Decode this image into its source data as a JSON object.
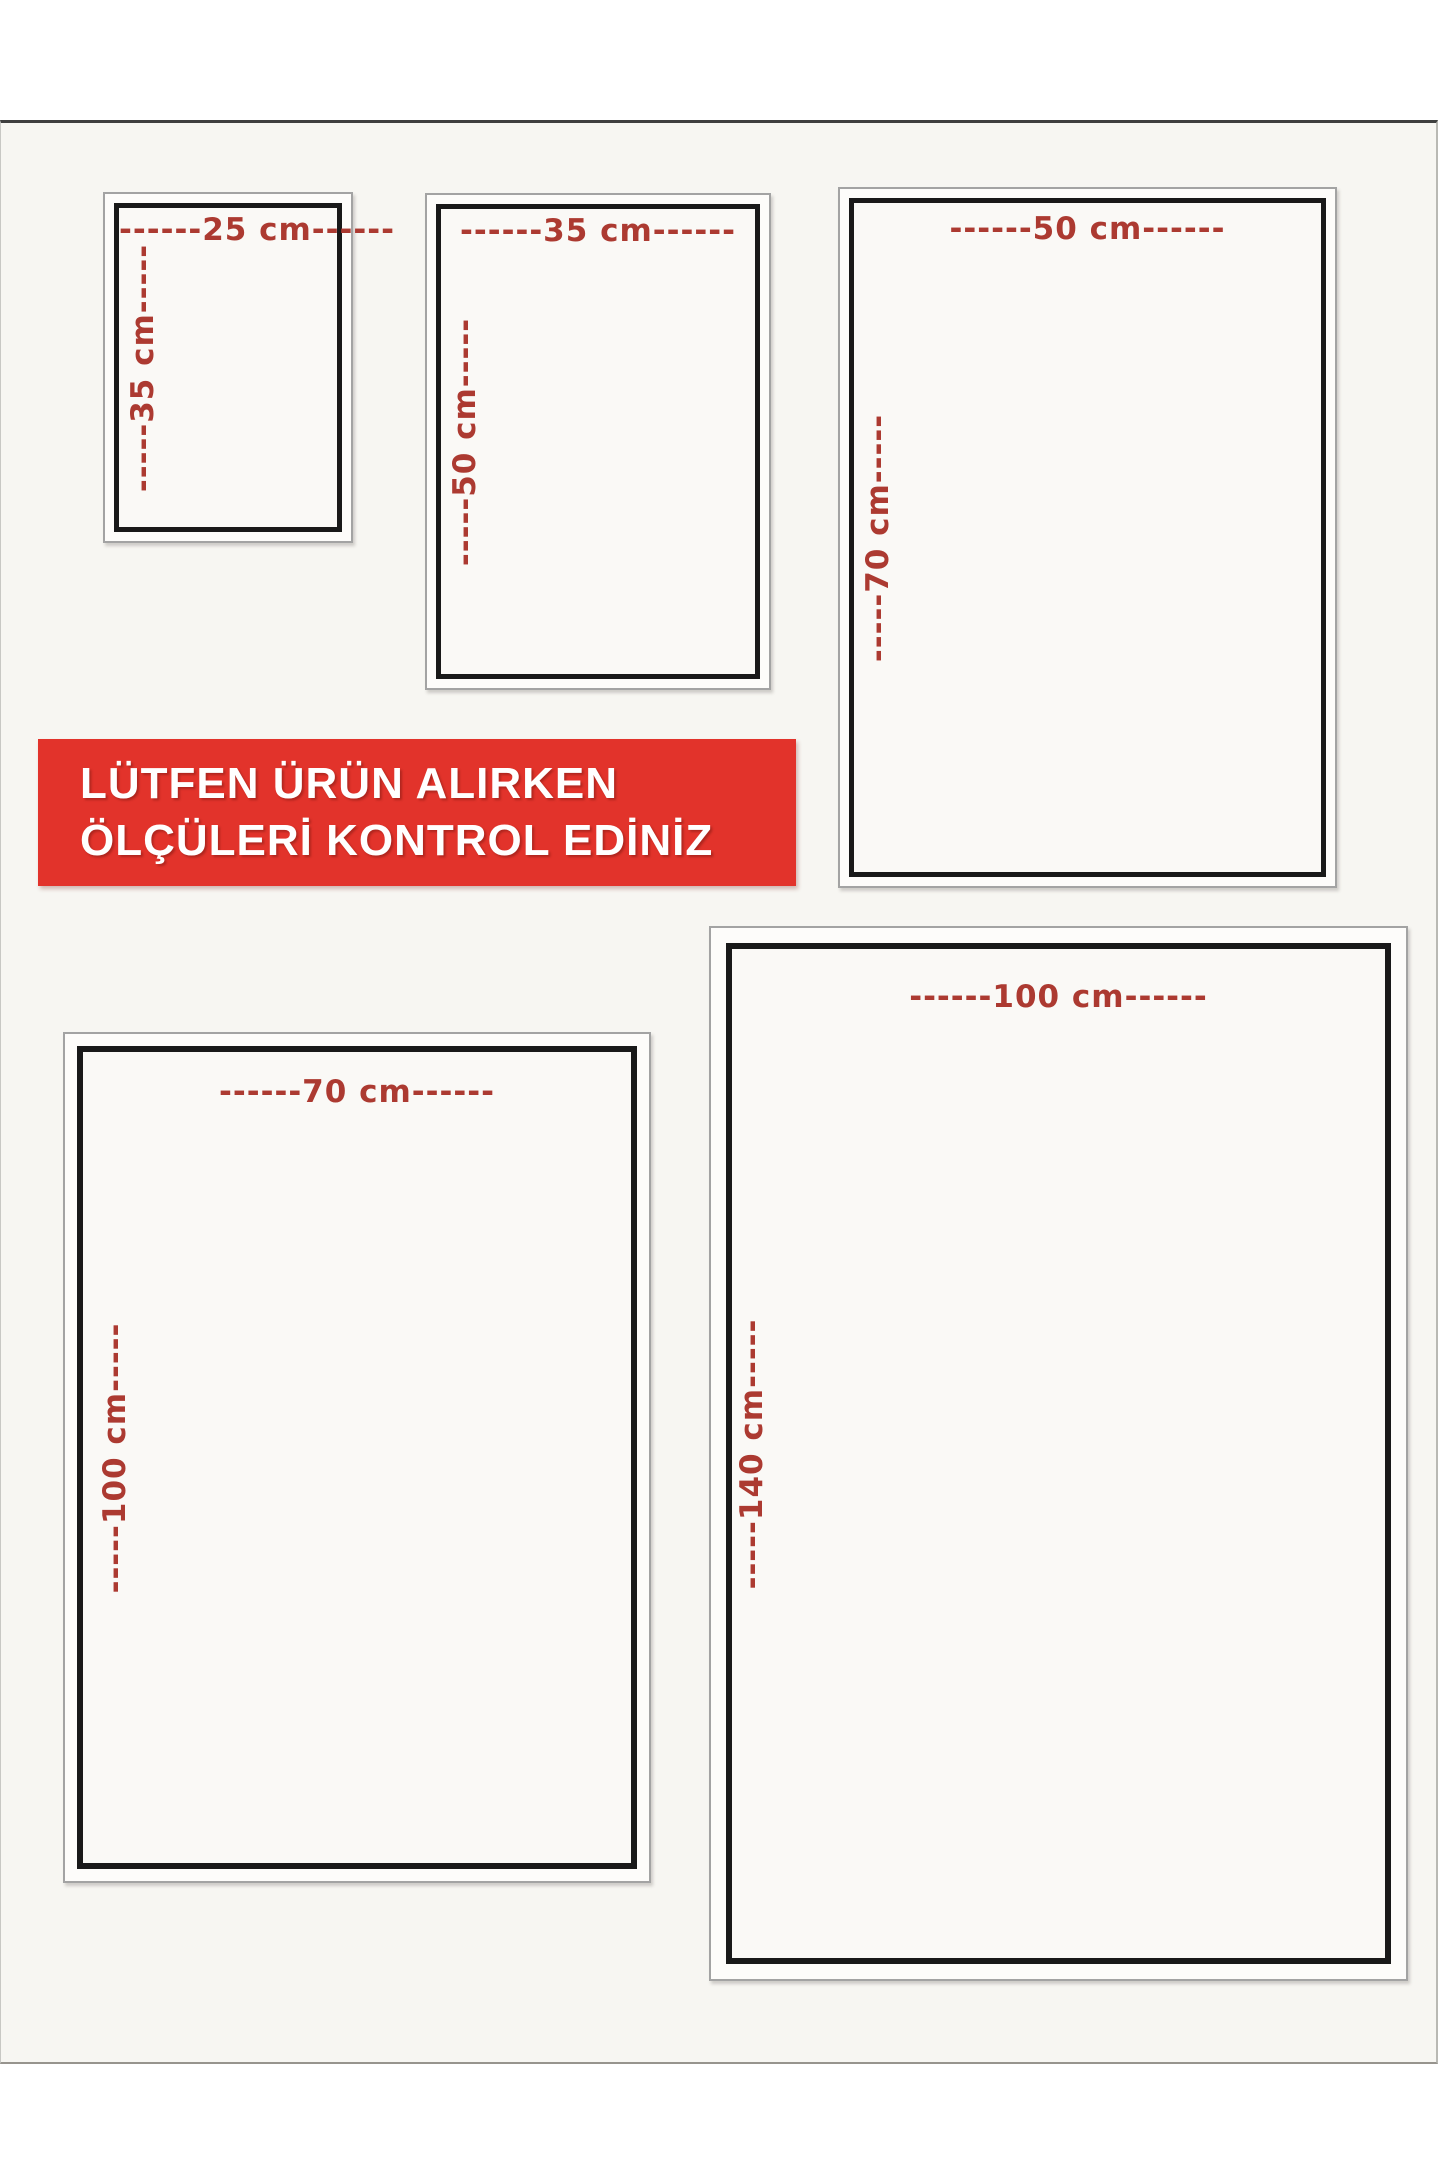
{
  "banner": {
    "line1": "LÜTFEN ÜRÜN ALIRKEN",
    "line2": "ÖLÇÜLERİ KONTROL EDİNİZ"
  },
  "boxes": [
    {
      "size": "25 x 35 cm",
      "width_cm": 25,
      "height_cm": 35,
      "width_label": "------25 cm------",
      "height_label": "-----35 cm-----"
    },
    {
      "size": "35 x 50 cm",
      "width_cm": 35,
      "height_cm": 50,
      "width_label": "------35 cm------",
      "height_label": "-----50 cm-----"
    },
    {
      "size": "50 x 70 cm",
      "width_cm": 50,
      "height_cm": 70,
      "width_label": "------50 cm------",
      "height_label": "-----70 cm-----"
    },
    {
      "size": "70 x 100 cm",
      "width_cm": 70,
      "height_cm": 100,
      "width_label": "------70 cm------",
      "height_label": "-----100 cm-----"
    },
    {
      "size": "100 x 140 cm",
      "width_cm": 100,
      "height_cm": 140,
      "width_label": "------100 cm------",
      "height_label": "-----140 cm-----"
    }
  ],
  "colors": {
    "background": "#f7f6f2",
    "banner_red": "#e2332b",
    "banner_text": "#ffffff",
    "label_red": "#ac3a31",
    "border_black": "#191919",
    "frame_gray": "#a3a3a3",
    "edge_dark": "#3f3f3f"
  }
}
